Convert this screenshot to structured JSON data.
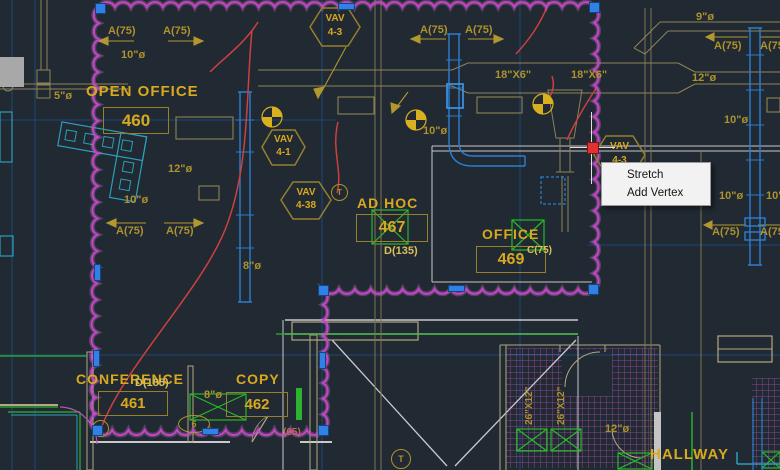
{
  "context_menu": {
    "items": [
      {
        "label": "Stretch"
      },
      {
        "label": "Add Vertex"
      }
    ]
  },
  "rooms": {
    "open_office": {
      "name": "OPEN OFFICE",
      "number": "460"
    },
    "ad_hoc": {
      "name": "AD HOC",
      "number": "467"
    },
    "office": {
      "name": "OFFICE",
      "number": "469"
    },
    "conference": {
      "name": "CONFERENCE",
      "number": "461"
    },
    "copy": {
      "name": "COPY",
      "number": "462"
    },
    "hallway": {
      "name": "HALLWAY"
    }
  },
  "diffuser_tags": {
    "d185": "D(185)",
    "d135": "D(135)",
    "c75": "C(75)"
  },
  "vav_tags": [
    {
      "line1": "VAV",
      "line2": "4-3"
    },
    {
      "line1": "VAV",
      "line2": "4-1"
    },
    {
      "line1": "VAV",
      "line2": "4-38"
    },
    {
      "line1": "VAV",
      "line2": "4-3"
    }
  ],
  "duct_labels": {
    "a75": "A(75)",
    "s10": "10\"ø",
    "s12": "12\"ø",
    "s8": "8\"ø",
    "s9": "9\"ø",
    "s5": "5\"ø",
    "s18x6": "18\"X6\"",
    "s26x12": "26\"X12\"",
    "p65": "(65)",
    "tag6": "6",
    "tagT": "T"
  },
  "colors": {
    "background": "#212933",
    "grid": "#1c4b80",
    "revision_cloud": "#c844c8",
    "grip": "#3080e8",
    "hot_grip": "#e23131",
    "gold_text": "#d8a91e",
    "olive_text": "#ad922e",
    "red_line": "#ce4040",
    "blue_duct": "#2b7fd2",
    "green": "#2db32d",
    "menu_bg": "#f2f2f2"
  }
}
